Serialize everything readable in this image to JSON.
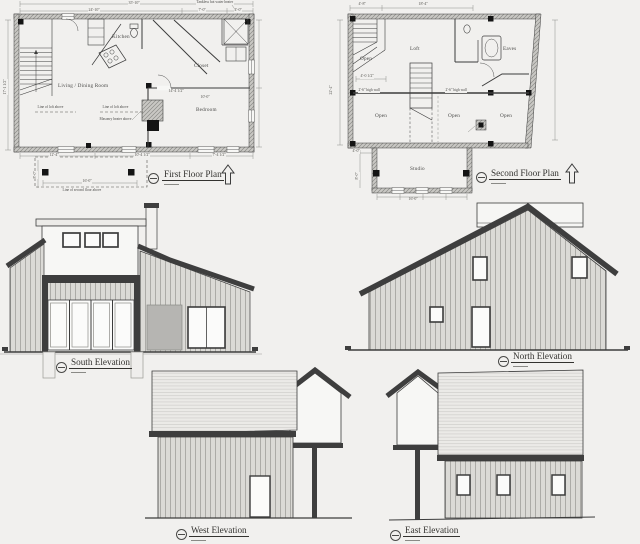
{
  "sheet": {
    "background": "#f1f0ee",
    "ink": "#3c3c3c",
    "dark_band": "#3e3e3e"
  },
  "first_floor_plan": {
    "title": "First Floor Plan",
    "rooms": {
      "kitchen": "Kitchen",
      "living_dining": "Living / Dining Room",
      "closet": "Closet",
      "bedroom": "Bedroom"
    },
    "annotations": {
      "tankless_heater": "Tankless hot water heater",
      "loft_above_left": "Line of loft above",
      "loft_above_right": "Line of loft above",
      "masonry_heater": "Masonry heater above",
      "second_floor_above": "Line of second floor above"
    },
    "dims": {
      "top_overall": "35'-10\"",
      "top_left": "24'-10\"",
      "top_mid": "7'-0\"",
      "top_right": "4'-0\"",
      "left_height": "17'-1 1/2\"",
      "bottom_left": "12'-4\"",
      "bottom_mid": "10'-4 1/2\"",
      "bottom_right": "7'-4 1/2\"",
      "porch_width": "16'-0\"",
      "porch_depth": "8'-0\"",
      "bedroom_width": "10'-0\"",
      "bedroom_upper": "14'-4 1/2\""
    }
  },
  "second_floor_plan": {
    "title": "Second Floor Plan",
    "rooms": {
      "open_nw": "Open",
      "loft": "Loft",
      "eaves": "Eaves",
      "open_sw": "Open",
      "open_s": "Open",
      "open_se": "Open",
      "studio": "Studio"
    },
    "notes": {
      "high_wall_left": "2'-6\" high wall",
      "high_wall_right": "2'-6\" high wall",
      "open_width": "4'-0 1/2\""
    },
    "dims": {
      "top_left": "4'-8\"",
      "top_mid": "18'-4\"",
      "left_height": "22'-4\"",
      "studio_width": "16'-0\"",
      "studio_offset": "4'-0\"",
      "studio_depth": "8'-0\""
    }
  },
  "elevations": {
    "south": "South Elevation",
    "north": "North Elevation",
    "west": "West Elevation",
    "east": "East Elevation"
  }
}
